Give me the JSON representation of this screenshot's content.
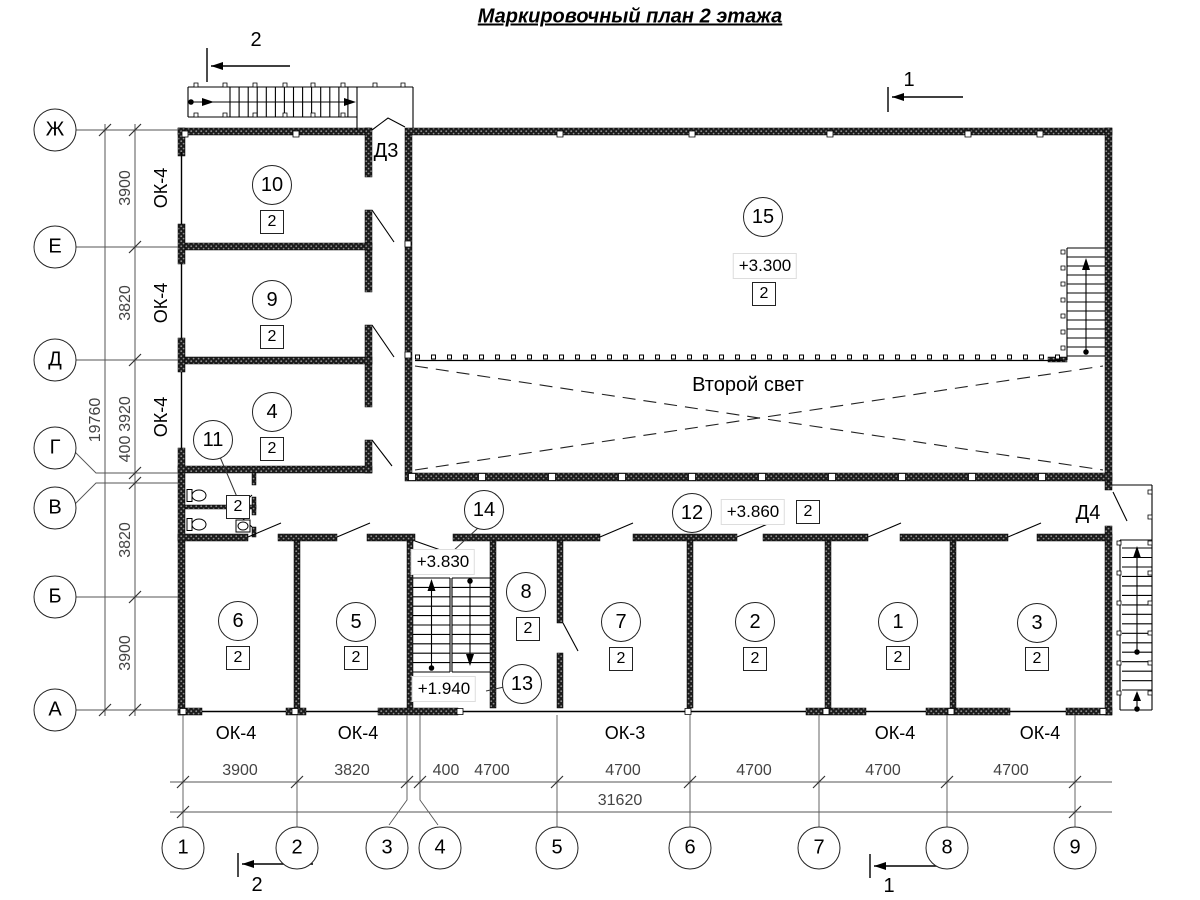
{
  "title": "Маркировочный план 2 этажа",
  "second_light": "Второй свет",
  "doors": {
    "d3": "Д3",
    "d4": "Д4"
  },
  "section_marks": {
    "top_left": "2",
    "top_right": "1",
    "bottom_left": "2",
    "bottom_right": "1"
  },
  "axes_left": [
    "Ж",
    "Е",
    "Д",
    "Г",
    "В",
    "Б",
    "А"
  ],
  "axes_bottom": [
    "1",
    "2",
    "3",
    "4",
    "5",
    "6",
    "7",
    "8",
    "9"
  ],
  "dims_left": [
    "3900",
    "3820",
    "3920",
    "400",
    "3820",
    "3900"
  ],
  "dims_left_total": "19760",
  "dims_bottom": [
    "3900",
    "3820",
    "400",
    "4700",
    "4700",
    "4700",
    "4700",
    "4700"
  ],
  "dims_bottom_total": "31620",
  "windows_left": [
    "ОК-4",
    "ОК-4",
    "ОК-4"
  ],
  "windows_bottom": [
    "ОК-4",
    "ОК-4",
    "ОК-3",
    "ОК-4",
    "ОК-4"
  ],
  "rooms": [
    {
      "number": "10",
      "type": "2"
    },
    {
      "number": "9",
      "type": "2"
    },
    {
      "number": "4",
      "type": "2"
    },
    {
      "number": "11",
      "type": "2"
    },
    {
      "number": "15",
      "type": "2",
      "elevation": "+3.300"
    },
    {
      "number": "14",
      "elevation": "+3.830"
    },
    {
      "number": "12",
      "type": "2",
      "elevation": "+3.860"
    },
    {
      "number": "8",
      "type": "2"
    },
    {
      "number": "13",
      "elevation": "+1.940"
    },
    {
      "number": "6",
      "type": "2"
    },
    {
      "number": "5",
      "type": "2"
    },
    {
      "number": "7",
      "type": "2"
    },
    {
      "number": "2",
      "type": "2"
    },
    {
      "number": "1",
      "type": "2"
    },
    {
      "number": "3",
      "type": "2"
    }
  ]
}
